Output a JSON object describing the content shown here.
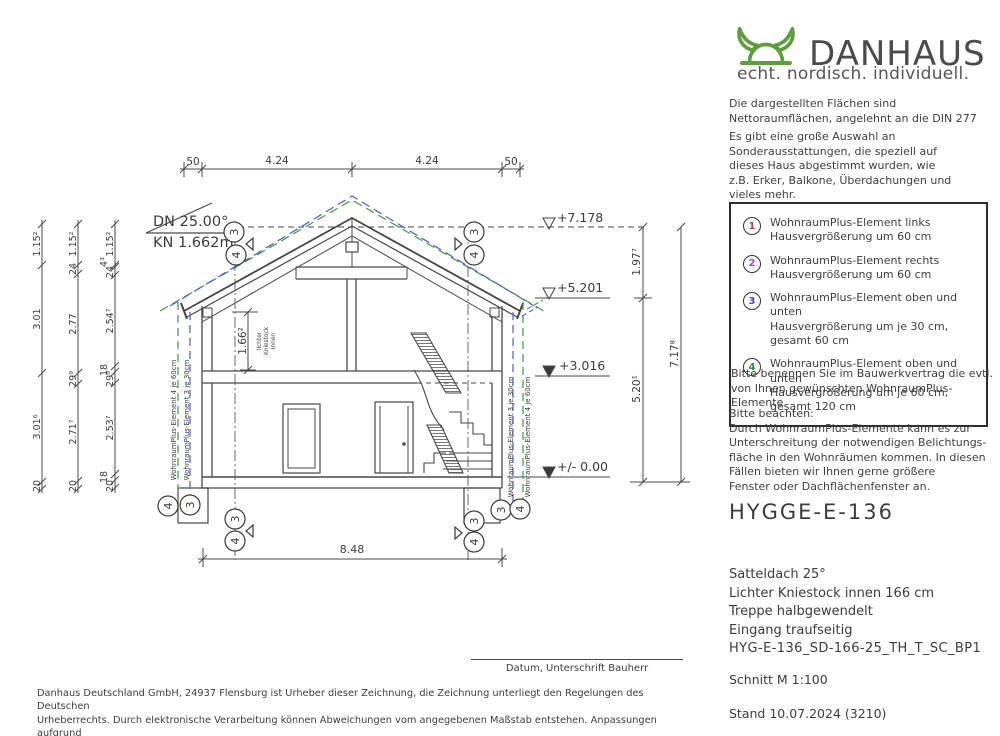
{
  "logo": {
    "brand": "DANHAUS",
    "tagline": "echt. nordisch. individuell.",
    "helmet_icon": "viking-helmet"
  },
  "colors": {
    "brand_green": "#5f9e3e",
    "marker_1": "#c23a3a",
    "marker_2": "#ad49ad",
    "marker_3": "#3f48c4",
    "marker_4": "#2f8c3f",
    "dash_blue": "#4a5fd0",
    "dash_green": "#3a9a45"
  },
  "intro": {
    "p1_lines": [
      "Die dargestellten Flächen sind",
      "Nettoraumflächen, angelehnt an die DIN 277"
    ],
    "p2_lines": [
      "Es gibt eine große Auswahl an",
      "Sonderausstattungen, die speziell auf",
      "dieses Haus abgestimmt wurden, wie",
      "z.B. Erker, Balkone, Überdachungen und",
      "vieles mehr."
    ]
  },
  "options_box": {
    "items": [
      {
        "num": "1",
        "lines": [
          "WohnraumPlus-Element links",
          "Hausvergrößerung um 60 cm"
        ]
      },
      {
        "num": "2",
        "lines": [
          "WohnraumPlus-Element rechts",
          "Hausvergrößerung um 60 cm"
        ]
      },
      {
        "num": "3",
        "lines": [
          "WohnraumPlus-Element oben und unten",
          "Hausvergrößerung um je 30 cm,",
          "gesamt 60 cm"
        ]
      },
      {
        "num": "4",
        "lines": [
          "WohnraumPlus-Element oben und unten",
          "Hausvergrößerung um je 60 cm,",
          "gesamt 120 cm"
        ]
      }
    ]
  },
  "notes": {
    "n1_lines": [
      "Bitte benennen Sie im Bauwerkvertrag die evtl.",
      "von Ihnen gewünschten WohnraumPlus-Elemente."
    ],
    "n2_lines": [
      "Bitte beachten:",
      "Durch WohnraumPlus-Elemente kann es zur",
      "Unterschreitung der notwendigen Belichtungs-",
      "fläche in den Wohnräumen kommen. In diesen",
      "Fällen bieten wir Ihnen gerne größere",
      "Fenster oder Dachflächenfenster an."
    ]
  },
  "title_block": {
    "model": "HYGGE-E-136",
    "specs": [
      "Satteldach 25°",
      "Lichter Kniestock innen 166 cm",
      "Treppe halbgewendelt",
      "Eingang traufseitig"
    ],
    "code": "HYG-E-136_SD-166-25_TH_T_SC_BP1",
    "section": "Schnitt M 1:100",
    "stand": "Stand 10.07.2024 (3210)"
  },
  "signature": {
    "label": "Datum, Unterschrift Bauherr"
  },
  "disclaimer_lines": [
    "Danhaus Deutschland GmbH, 24937 Flensburg ist Urheber dieser Zeichnung, die Zeichnung unterliegt den Regelungen des Deutschen",
    "Urheberrechts. Durch elektronische Verarbeitung können Abweichungen vom angegebenen Maßstab entstehen. Anpassungen aufgrund",
    "technischer Änderungen oder Produktanpassungen bleiben vorbehalten. Sonderausstattungen werden mit „optional“ gekennzeichnet."
  ],
  "drawing": {
    "dn": "DN 25.00°",
    "kn": "KN 1.662m",
    "top_dims": [
      "50",
      "4.24",
      "4.24",
      "50"
    ],
    "bottom_dim": "8.48",
    "levels": [
      "+7.178",
      "+5.201",
      "+3.016",
      "+/- 0.00"
    ],
    "right_dims": [
      "1.97⁷",
      "5.20¹",
      "7.17⁸"
    ],
    "chain1": [
      "1.15²",
      "3.01",
      "3.01⁶",
      "20"
    ],
    "chain2": [
      "1.15²",
      "24",
      "2.77",
      "29⁹",
      "2.71⁷",
      "20"
    ],
    "chain3": [
      "1.15²",
      "4³",
      "24",
      "2.54⁷",
      "18",
      "29⁹",
      "2.53⁷",
      "18",
      "20"
    ],
    "kniestock_dim": "1.66²",
    "kniestock_note": [
      "lichter",
      "Kniestock",
      "innen"
    ],
    "wplus": {
      "left_outer": "WohnraumPlus-Element 4 je 60cm",
      "left_inner": "WohnraumPlus-Element 3 je 30cm",
      "right_inner": "WohnraumPlus-Element 3 je 30cm",
      "right_outer": "WohnraumPlus-Element 4 je 60cm"
    },
    "m3": "3",
    "m4": "4"
  }
}
